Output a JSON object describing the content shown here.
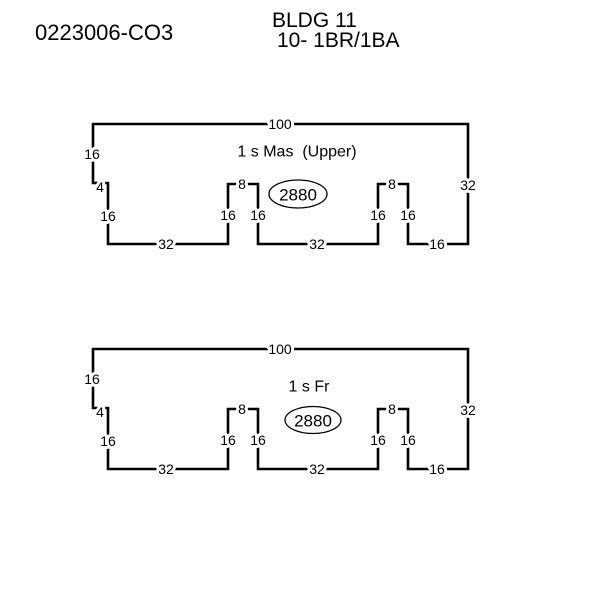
{
  "colors": {
    "background": "#ffffff",
    "line": "#000000",
    "text": "#000000"
  },
  "header": {
    "file_number": "0223006-CO3",
    "building": "BLDG 11",
    "units": "10- 1BR/1BA"
  },
  "sketches": [
    {
      "name": "1 s Mas  (Upper)",
      "area": "2880",
      "dims": {
        "top": "100",
        "left_upper": "16",
        "left_jog": "4",
        "left_lower": "16",
        "bottom_left": "32",
        "notch1_left": "16",
        "notch1_top": "8",
        "notch1_right": "16",
        "bottom_mid": "32",
        "notch2_left": "16",
        "notch2_top": "8",
        "notch2_right": "16",
        "bottom_right": "16",
        "right": "32"
      }
    },
    {
      "name": "1 s Fr",
      "area": "2880",
      "dims": {
        "top": "100",
        "left_upper": "16",
        "left_jog": "4",
        "left_lower": "16",
        "bottom_left": "32",
        "notch1_left": "16",
        "notch1_top": "8",
        "notch1_right": "16",
        "bottom_mid": "32",
        "notch2_left": "16",
        "notch2_top": "8",
        "notch2_right": "16",
        "bottom_right": "16",
        "right": "32"
      }
    }
  ]
}
